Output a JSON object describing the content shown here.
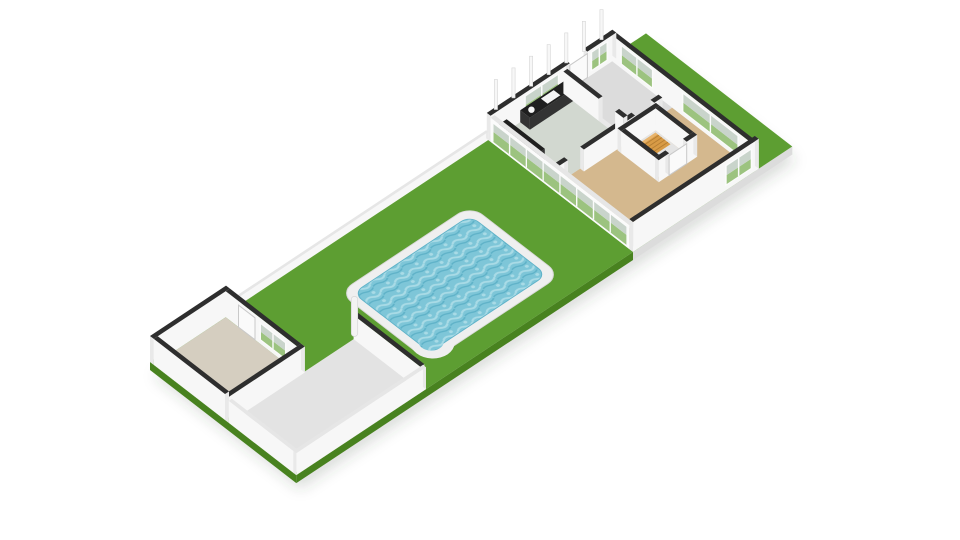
{
  "view": {
    "type": "3d-floorplan-dollhouse",
    "background": "#ffffff",
    "description": "Isometric 3D floor plan: ground floor of a terraced house (top right) with kitchen, hallway, enclosed staircase and living room; long garden with lawn, swimming pool, grey patio and a shed with beige floor (bottom left)."
  },
  "palette": {
    "background": "#ffffff",
    "lawn": "#5d9e32",
    "lawnEdge": "#48821f",
    "slabGrey": "#dcdcdc",
    "shadow": "rgba(60,70,60,0.18)",
    "patio": "#e3e3e3",
    "shedFloor": "#d5cec0",
    "houseSlab": "#e9e9e9",
    "living": "#d4b88e",
    "kitchen": "#d2d8d0",
    "hall": "#dcdcdc",
    "stairFloor": "#e4e4e4",
    "stairs": "#d89b46",
    "stairsLight": "#e8b46c",
    "stairTread": "#b57e33",
    "counter": "#1f1f1f",
    "counterFace": "#333333",
    "sink": "#f5f5f5",
    "capDark": "#2e2e2e",
    "capLight": "#e6e6e6",
    "faceLight": "#f7f7f7",
    "faceMid": "#e9e9e9",
    "glassGreen": "#9cc37f",
    "glassSky": "#c9d4cb",
    "frame": "#fbfbfb",
    "rim": "#efefef",
    "rimEdge": "#d9d9d9",
    "water": "#7ec6d8",
    "waterLight": "#a9dbe6",
    "waterDeep": "#5fb2c8",
    "post": "#f3f3f3",
    "stud": "#f7f7f7",
    "studEdge": "#d6d6d6",
    "doorWhite": "#fafafa",
    "doorEdge": "#c9c9c9"
  },
  "elements": {
    "garden-lawn": "Garden lawn",
    "patio-floor": "Paved patio",
    "shed-floor": "Shed / outbuilding floor",
    "swimming-pool": "Swimming pool with white surround",
    "house-floor-slab": "House floor slab",
    "living-room-floor": "Living room floor (wood/laminate)",
    "kitchen-floor": "Kitchen floor",
    "hallway-floor": "Entrance hall floor",
    "staircase": "Enclosed staircase with wooden steps",
    "kitchen-counter": "Dark kitchen counter with sink",
    "front-facade-wall": "Front facade with windows",
    "front-door": "Front door",
    "back-glazed-wall": "Rear glazed sliding doors",
    "boundary-walls": "Garden boundary walls",
    "patio-post": "White corner post",
    "upper-floor-studs": "Cut-off walls of upper storey"
  }
}
